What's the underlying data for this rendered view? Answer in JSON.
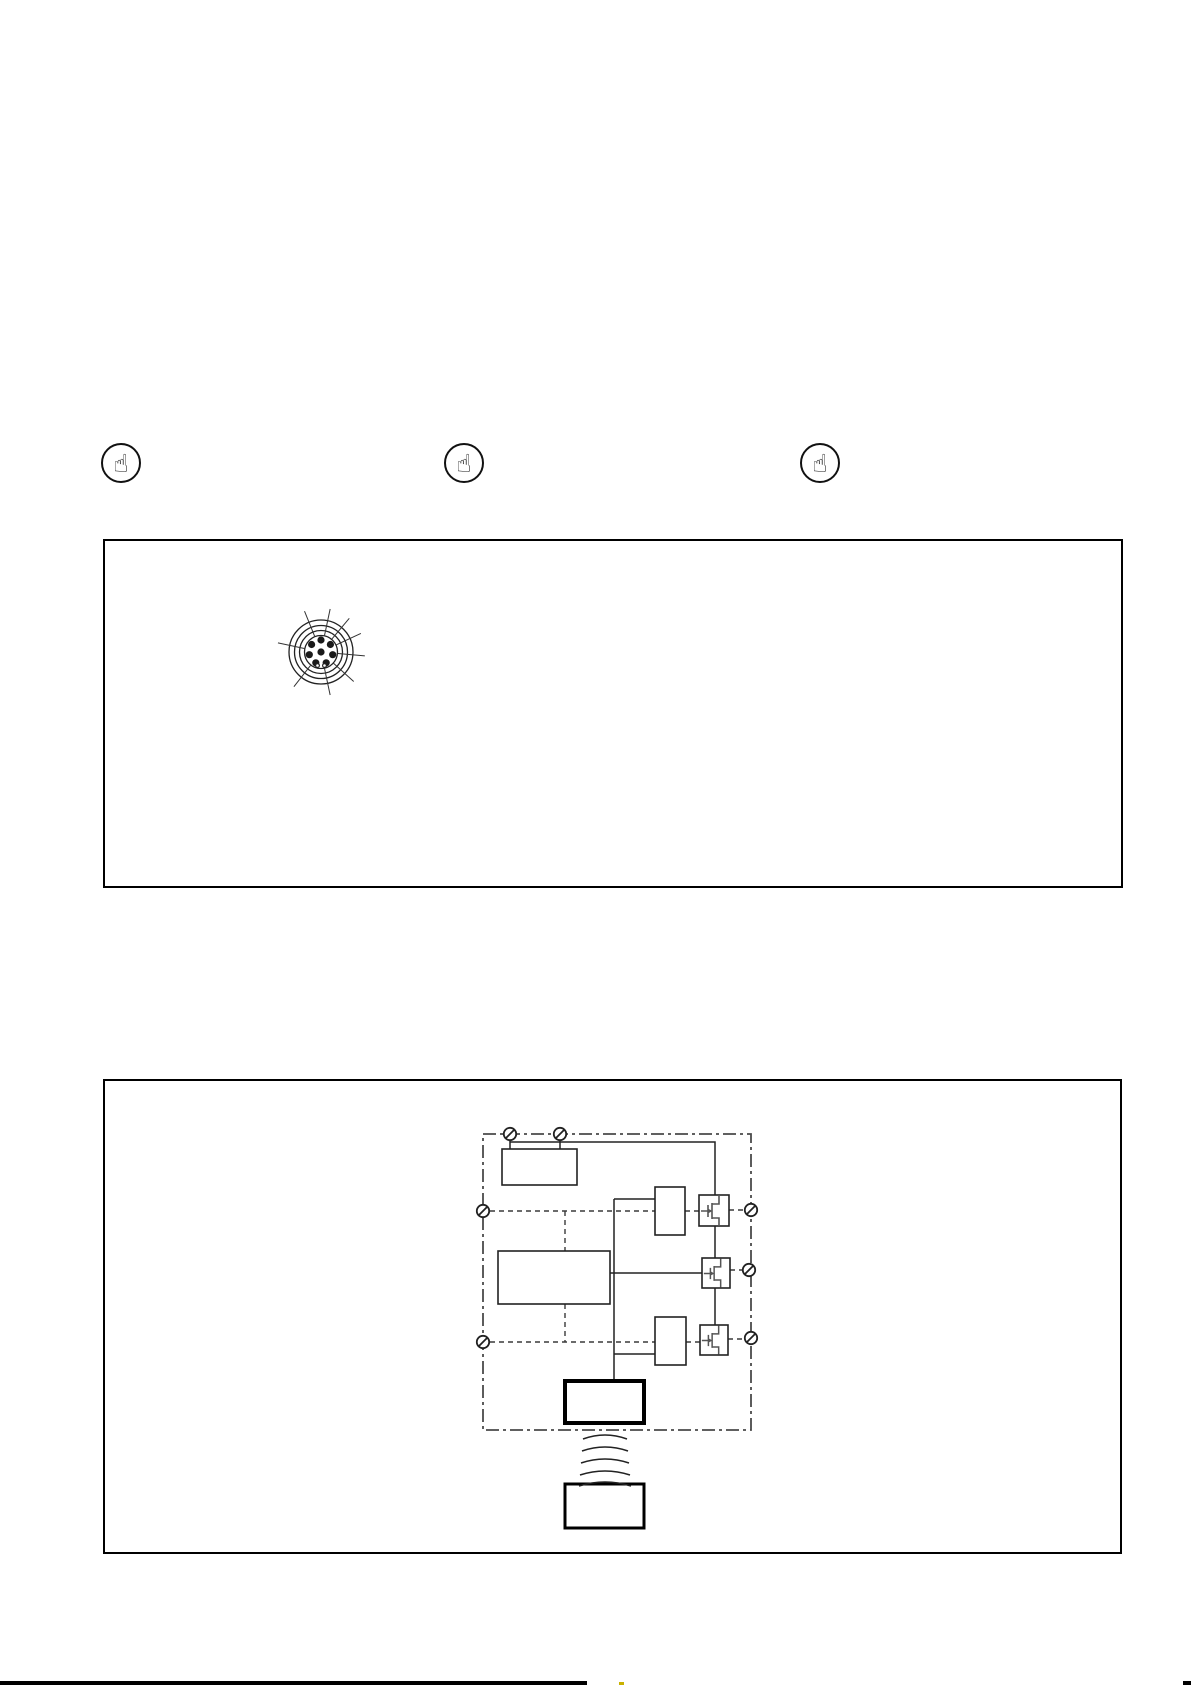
{
  "page": {
    "background": "#ffffff",
    "ink": "#1a1a1a",
    "note_icon_symbol": "☝",
    "note_icon_count": 3
  },
  "figures": {
    "connector_pinout": {
      "ring_radii": [
        32,
        26.5,
        21.5,
        16.5
      ],
      "pin_radius": 3.6,
      "pins": [
        [
          0,
          0
        ],
        [
          0,
          -12
        ],
        [
          -9.4,
          -7.5
        ],
        [
          9.4,
          -7.5
        ],
        [
          -11.7,
          2.7
        ],
        [
          11.7,
          2.7
        ],
        [
          -5.2,
          10.8
        ],
        [
          5.2,
          10.8
        ]
      ],
      "keyway_holes": [
        [
          -3.5,
          13.5
        ],
        [
          3.5,
          13.5
        ]
      ],
      "keyway_hole_radius": 1.9,
      "leader_angles_deg": [
        112,
        78,
        50,
        25,
        -5,
        -42,
        -78,
        -128,
        168
      ],
      "leader_inner_radius": 17,
      "leader_outer_radius": 44
    },
    "block_diagram": {
      "terminal_symbol": "circle-with-slash",
      "terminals": [
        [
          405,
          53
        ],
        [
          455,
          53
        ],
        [
          378,
          130
        ],
        [
          378,
          261
        ],
        [
          646,
          129
        ],
        [
          644,
          189
        ],
        [
          646,
          257
        ]
      ],
      "mosfet_count": 3,
      "driver_box_count": 2,
      "wave_arcs": {
        "center_x": 500,
        "ys": [
          355,
          367,
          379,
          391,
          402
        ],
        "half_widths": [
          22,
          23,
          24,
          25,
          26
        ]
      }
    }
  },
  "footer": {
    "bar_color": "#000000",
    "tick_color": "#c9b100"
  }
}
